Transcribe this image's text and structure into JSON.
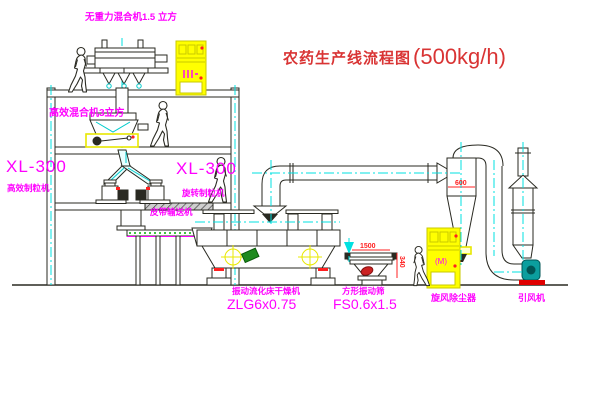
{
  "title": {
    "name": "农药生产线流程图",
    "capacity": "(500kg/h)"
  },
  "equipment_labels": {
    "gravity_free_mixer": "无重力混合机1.5 立方",
    "high_efficiency_mixer": "高效混合机3立方",
    "granulator_left_model": "XL-300",
    "granulator_left_name": "高效制粒机",
    "granulator_center_model": "XL-300",
    "granulator_center_name": "旋转制粒机",
    "belt_conveyor": "皮带输送机",
    "fluid_bed_dryer_name": "振动流化床干燥机",
    "fluid_bed_dryer_model": "ZLG6x0.75",
    "vibrating_sieve_name": "方形振动筛",
    "vibrating_sieve_model": "FS0.6x1.5",
    "cyclone": "旋风除尘器",
    "induced_draft_fan": "引风机",
    "control_cabinet_mark": "(M)"
  },
  "dimensions": {
    "cyclone_diameter": "600",
    "sieve_length": "1500",
    "sieve_height": "340"
  },
  "colors": {
    "label": "#ff00ff",
    "title": "#d93434",
    "dimension": "#ff2020",
    "line": "#2a2a22",
    "centerline": "#00e0e0",
    "highlight": "#ffff00",
    "fan": "#0b9e9e"
  }
}
